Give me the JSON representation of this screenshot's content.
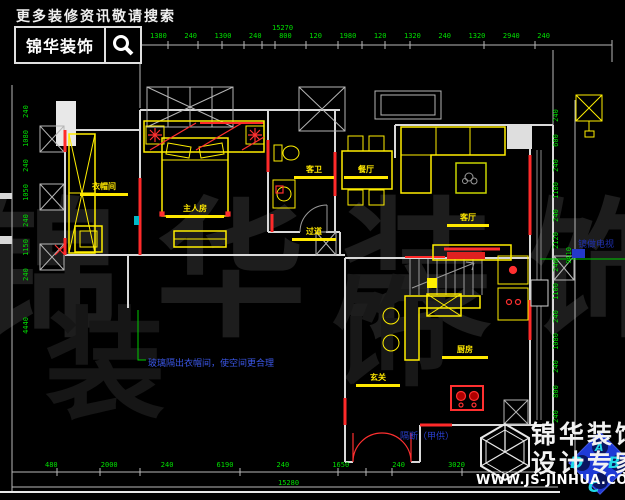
{
  "header": {
    "tagline": "更多装修资讯敬请搜索",
    "brand": "锦华装饰"
  },
  "watermark": {
    "main": "锦华装饰",
    "partial1": "装",
    "partial2": "饰"
  },
  "rooms": {
    "cloakroom": "衣帽间",
    "master_bedroom": "主人房",
    "guest_bath": "客卫",
    "dining": "餐厅",
    "corridor": "过道",
    "living": "客厅",
    "kitchen": "厨房",
    "entry": "玄关"
  },
  "annotations": {
    "glass_note": "玻璃隔出衣帽间，使空间更合理",
    "partition_legend": "隔断（甲供）",
    "tv_wall_note": "镜做电视"
  },
  "dimensions": {
    "top": {
      "total": "15270",
      "segments": [
        "1380",
        "240",
        "1300",
        "240",
        "800",
        "120",
        "1980",
        "120",
        "1320",
        "240",
        "1320",
        "2940",
        "240"
      ]
    },
    "bottom": {
      "total": "15280",
      "segments": [
        "480",
        "2000",
        "240",
        "6190",
        "240",
        "1650",
        "240",
        "3020"
      ]
    },
    "left": {
      "segments": [
        "240",
        "1080",
        "240",
        "1050",
        "240",
        "1150",
        "240"
      ],
      "last": "4440"
    },
    "right": {
      "segments": [
        "240",
        "600",
        "240",
        "1180",
        "240",
        "2120",
        "240",
        "1100",
        "240",
        "1080",
        "240",
        "800",
        "240"
      ],
      "overall": "9410"
    }
  },
  "footer": {
    "brand_top": "锦华装饰",
    "brand_bottom": "设计专家",
    "website": "WWW.JS-JINHUA.COM",
    "compass": {
      "a": "A",
      "b": "B",
      "c": "C",
      "d": "D"
    }
  }
}
